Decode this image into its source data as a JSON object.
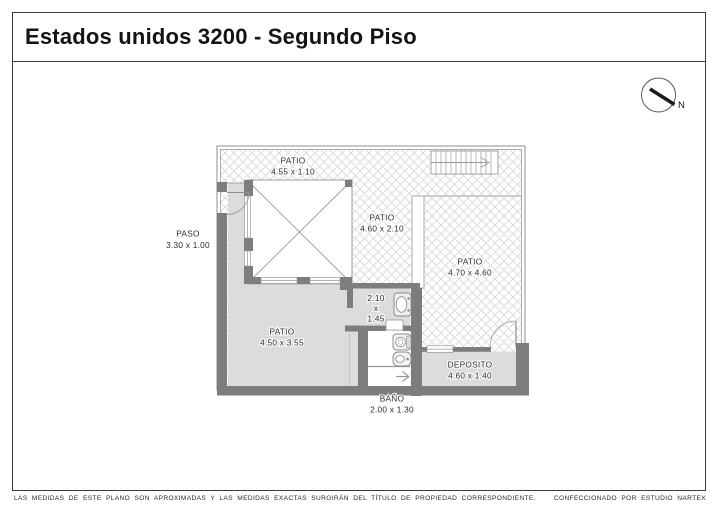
{
  "title": "Estados unidos 3200 - Segundo Piso",
  "compass": {
    "north_label": "N"
  },
  "rooms": {
    "top_patio": {
      "label": "PATIO",
      "dims": "4.55 x 1.10"
    },
    "paso": {
      "label": "PASO",
      "dims": "3.30 x 1.00"
    },
    "mid_patio": {
      "label": "PATIO",
      "dims": "4.60 x 2.10"
    },
    "right_patio": {
      "label": "PATIO",
      "dims": "4.70 x 4.60"
    },
    "main_patio": {
      "label": "PATIO",
      "dims": "4.50 x 3.55"
    },
    "toilette": {
      "line1": "2.10",
      "line2": "x",
      "line3": "1.45"
    },
    "deposito": {
      "label": "DEPOSITO",
      "dims": "4.60 x 1.40"
    },
    "bano": {
      "label": "BAÑO",
      "dims": "2.00 x 1.30"
    }
  },
  "footer": {
    "disclaimer": "LAS MEDIDAS DE ESTE PLANO SON APROXIMADAS Y LAS MEDIDAS EXACTAS SURGIRÁN DEL TÍTULO DE PROPIEDAD CORRESPONDIENTE.",
    "credit": "CONFECCIONADO POR ESTUDIO NARTEX"
  },
  "colors": {
    "wall": "#7d7d7d",
    "room_fill": "#dcdcdc",
    "hatch_line": "#d9d9d9",
    "outline": "#999999",
    "label_text": "#2e2e2e"
  }
}
